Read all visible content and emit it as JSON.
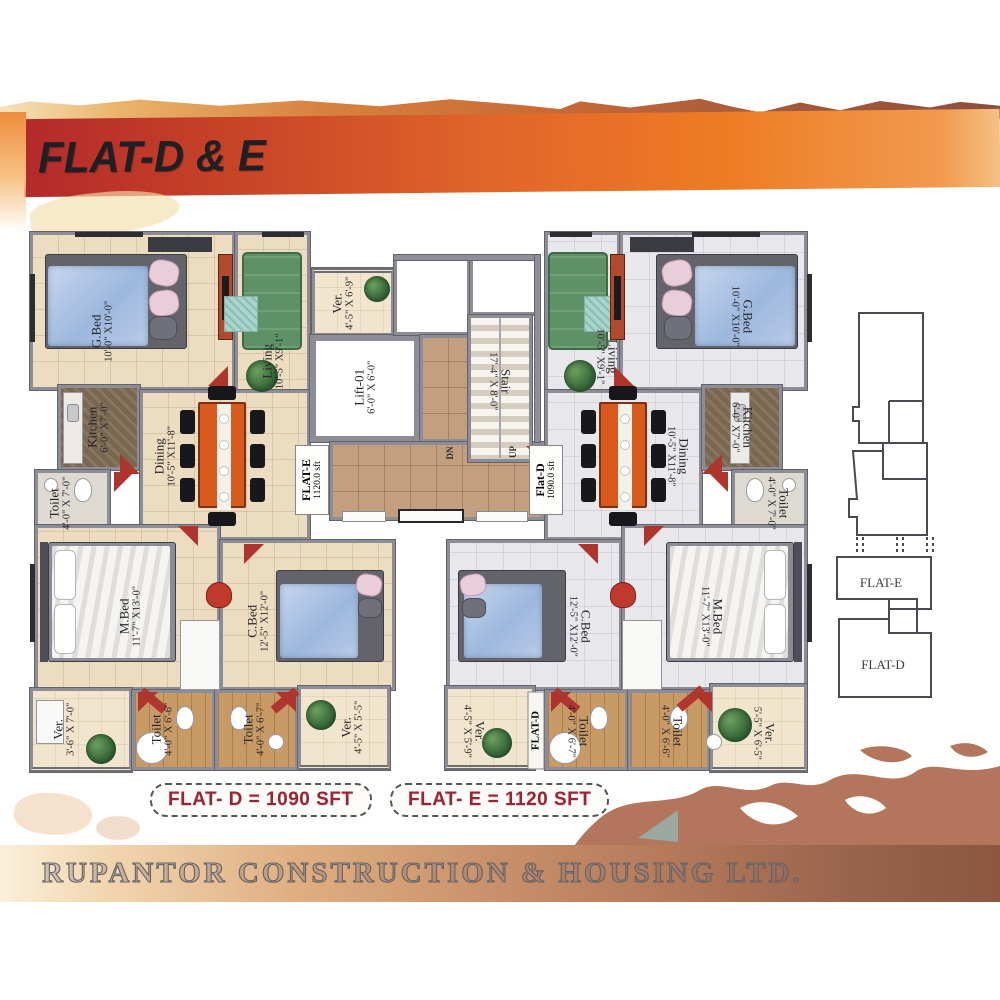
{
  "banner": {
    "title": "FLAT-D & E"
  },
  "palette": {
    "banner_red": "#b4292a",
    "banner_orange": "#ee7c24",
    "area_label_red": "#9e2134",
    "splash_brown": "#b3755b"
  },
  "core": {
    "lift": {
      "name": "Lift-01",
      "dims": "6'-0\" X 6'-0\""
    },
    "stair": {
      "name": "Stair",
      "dims": "17'-4\" X 8'-0\""
    },
    "dn": "DN",
    "up": "UP"
  },
  "flat_e": {
    "door_tag": {
      "line1": "FLAT-E",
      "line2": "1120.0 sft"
    },
    "rooms": {
      "gbed": {
        "name": "G.Bed",
        "dims": "10'-0\" X10'-0\""
      },
      "living": {
        "name": "Living",
        "dims": "10'-5\" X9'-1\""
      },
      "ver_top": {
        "name": "Ver.",
        "dims": "4'-5\" X 6'-9\""
      },
      "kitchen": {
        "name": "Kitchen",
        "dims": "6'-0\" X7'-0\""
      },
      "dining": {
        "name": "Dining",
        "dims": "10'-5\" X11'-8\""
      },
      "toilet": {
        "name": "Toilet",
        "dims": "4'-0\" X 7'-0\""
      },
      "mbed": {
        "name": "M.Bed",
        "dims": "11'-7\" X13'-0\""
      },
      "cbed": {
        "name": "C.Bed",
        "dims": "12'-5\" X12'-0\""
      },
      "ver_left": {
        "name": "Ver.",
        "dims": "3'-6\" X 7'-0\""
      },
      "toilet_b1": {
        "name": "Toilet",
        "dims": "4'-0\" X 6'-6\""
      },
      "toilet_b2": {
        "name": "Toilet",
        "dims": "4'-0\" X 6'-7\""
      },
      "ver_right": {
        "name": "Ver.",
        "dims": "4'-5\" X 5'-5\""
      }
    }
  },
  "flat_d": {
    "door_tag": {
      "line1": "Flat-D",
      "line2": "1090.0 sft"
    },
    "entry_tag": "FLAT-D",
    "rooms": {
      "living": {
        "name": "Living",
        "dims": "10'-5\" X9'-1\""
      },
      "gbed": {
        "name": "G.Bed",
        "dims": "10'-0\" X10'-0\""
      },
      "dining": {
        "name": "Dining",
        "dims": "10'-5\" X11'-8\""
      },
      "kitchen": {
        "name": "Kitchen",
        "dims": "6'-0\" X7'-0\""
      },
      "toilet": {
        "name": "Toilet",
        "dims": "4'-0\" X 7'-0\""
      },
      "cbed": {
        "name": "C.Bed",
        "dims": "12'-5\" X12'-0\""
      },
      "mbed": {
        "name": "M.Bed",
        "dims": "11'-7\" X13'-0\""
      },
      "ver_left": {
        "name": "Ver.",
        "dims": "4'-5\" X 5'-9\""
      },
      "toilet_b1": {
        "name": "Toilet",
        "dims": "4'-0\" X 6'-7\""
      },
      "toilet_b2": {
        "name": "Toilet",
        "dims": "4'-0\" X 6'-6\""
      },
      "ver_right": {
        "name": "Ver.",
        "dims": "5'-5\" X 6'-5\""
      }
    }
  },
  "keyplan": {
    "flat_e": "FLAT-E",
    "flat_d": "FLAT-D"
  },
  "area_tags": {
    "flat_d": "FLAT- D = 1090 SFT",
    "flat_e": "FLAT- E = 1120 SFT"
  },
  "footer": {
    "company": "RUPANTOR CONSTRUCTION & HOUSING LTD."
  }
}
